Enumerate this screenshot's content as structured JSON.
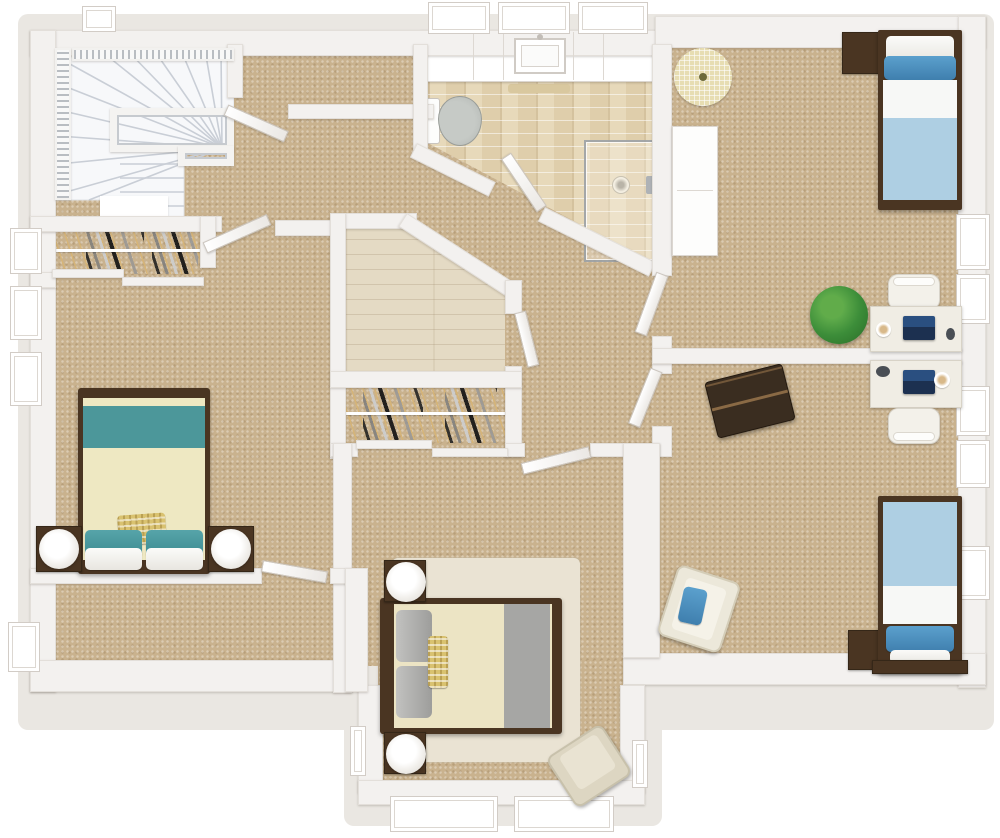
{
  "meta": {
    "image_type": "3d-floor-plan-render",
    "view": "top-down",
    "floor_shown": "upper floor with stairwell",
    "visible_text": "none"
  },
  "palette": {
    "ground": "#eae7e2",
    "wall": "#f3f1ef",
    "carpet": "#c9b28e",
    "tile": "#e7d9ba",
    "wood": "#e4dac4",
    "stair_fill": "#f7f8fa",
    "stair_line": "#c9ced6",
    "dark_wood": "#4a3522",
    "teal": "#3e8f97",
    "cream_blanket": "#eee8c2",
    "gray_fabric": "#a6a6a4",
    "light_blue": "#aecfe3",
    "accent_blue": "#4e97c5",
    "navy_laptop": "#22406b",
    "plant_green": "#3f8c3c",
    "rug_cream": "#eae3d3",
    "round_rug": "#e7ddb2",
    "yellow": "#d9c270",
    "armchair_beige": "#ddd6c2",
    "trunk_brown": "#3a2d20"
  },
  "rooms": [
    {
      "id": "stairwell",
      "name": "stairwell-landing",
      "floor": "white stairs + tan carpet",
      "features": [
        "winder-staircase",
        "stair-railing",
        "stairwell-opening-railing"
      ]
    },
    {
      "id": "bathroom",
      "name": "bathroom",
      "floor": "beige brick tile",
      "features": [
        "vanity-counter",
        "sink",
        "toilet",
        "corner-shower",
        "bath-mat",
        "three-windows",
        "angled-entry-door"
      ]
    },
    {
      "id": "left-bedroom",
      "name": "left-bedroom",
      "floor": "tan carpet",
      "features": [
        "double-bed-teal-cream",
        "two-nightstands",
        "two-lamps",
        "reach-in-closet-with-clothes",
        "two-windows"
      ]
    },
    {
      "id": "center-storage",
      "name": "walk-in-room-wood-floor",
      "floor": "light wood planks",
      "features": [
        "angled-corner-wall",
        "side-door"
      ]
    },
    {
      "id": "bottom-bedroom",
      "name": "bottom-bedroom",
      "floor": "tan carpet",
      "features": [
        "queen-bed-cream-gray",
        "area-rug",
        "two-nightstands-with-lamps",
        "armchair",
        "closet-with-clothes",
        "bay-windows"
      ]
    },
    {
      "id": "top-right-bedroom",
      "name": "top-right-bedroom",
      "floor": "tan carpet",
      "features": [
        "twin-bed-blue",
        "nightstand",
        "round-rug",
        "white-wardrobe",
        "desk-with-chair-and-laptop",
        "potted-plant",
        "windows"
      ]
    },
    {
      "id": "bottom-right-bedroom",
      "name": "bottom-right-bedroom",
      "floor": "tan carpet",
      "features": [
        "twin-bed-blue",
        "nightstand",
        "desk-with-chair-and-laptop",
        "dark-trunk",
        "cream-armchair-blue-pillow",
        "windows"
      ]
    },
    {
      "id": "hallway",
      "name": "central-hallway",
      "floor": "tan carpet",
      "features": [
        "diagonal-corridor",
        "multiple-doors"
      ]
    }
  ],
  "counts": {
    "beds": 4,
    "desks": 2,
    "closets_with_clothes": 2,
    "lamps": 4,
    "doors_open": 8,
    "windows": 16
  }
}
